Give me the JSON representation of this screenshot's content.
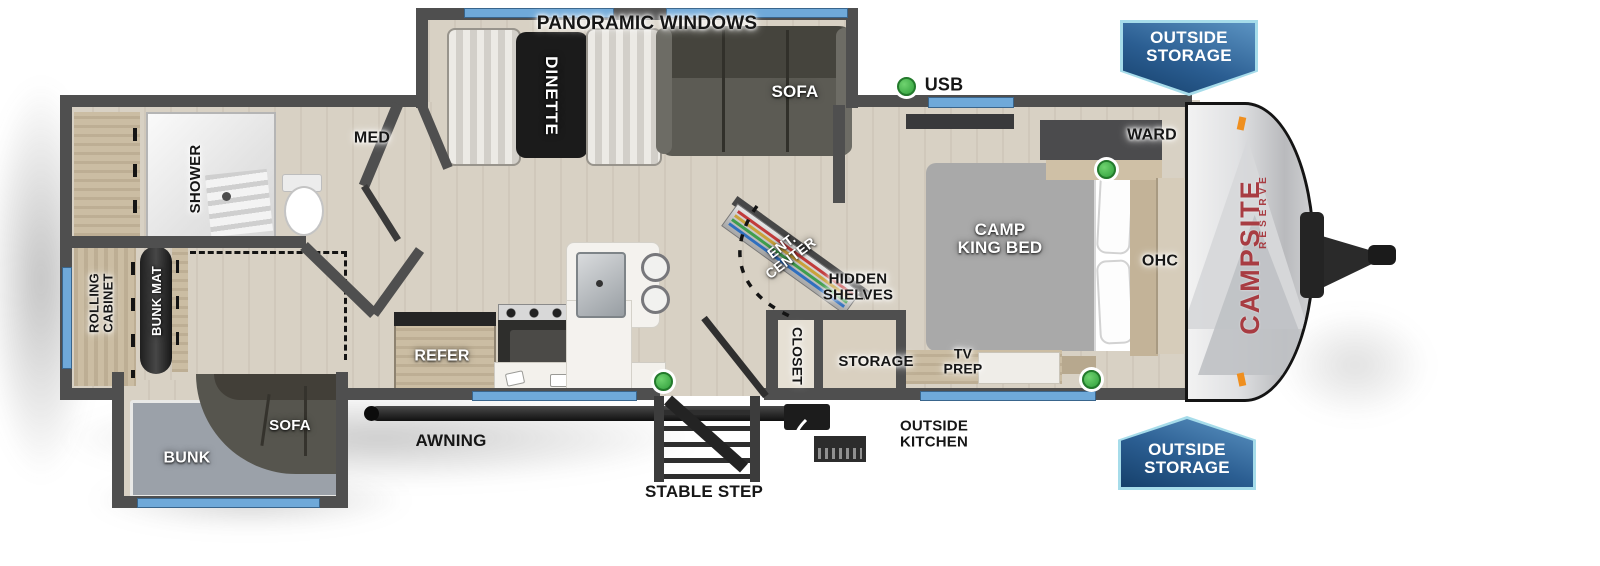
{
  "brand": {
    "line1": "CAMPSITE",
    "line2": "RESERVE",
    "color": "#a83c42"
  },
  "badges": {
    "outside_storage_top": {
      "line1": "OUTSIDE",
      "line2": "STORAGE"
    },
    "outside_storage_bottom": {
      "line1": "OUTSIDE",
      "line2": "STORAGE"
    }
  },
  "indicators": {
    "usb": {
      "label": "USB",
      "dot_color": "#3fae4c"
    }
  },
  "labels": {
    "panoramic_windows": {
      "text": "PANORAMIC WINDOWS"
    },
    "dinette": {
      "text": "DINETTE"
    },
    "sofa_main": {
      "text": "SOFA"
    },
    "med": {
      "text": "MED"
    },
    "shower": {
      "text": "SHOWER"
    },
    "ward": {
      "text": "WARD"
    },
    "ohc": {
      "text": "OHC"
    },
    "camp_king_bed": {
      "line1": "CAMP",
      "line2": "KING BED"
    },
    "ent_center": {
      "line1": "ENT.",
      "line2": "CENTER"
    },
    "hidden_shelves": {
      "line1": "HIDDEN",
      "line2": "SHELVES"
    },
    "closet": {
      "text": "CLOSET"
    },
    "storage": {
      "text": "STORAGE"
    },
    "tv_prep": {
      "line1": "TV",
      "line2": "PREP"
    },
    "refer": {
      "text": "REFER"
    },
    "rolling_cabinet": {
      "line1": "ROLLING",
      "line2": "CABINET"
    },
    "bunk_mat": {
      "text": "BUNK MAT"
    },
    "sofa_slide": {
      "text": "SOFA"
    },
    "bunk": {
      "text": "BUNK"
    },
    "awning": {
      "text": "AWNING"
    },
    "stable_step": {
      "text": "STABLE STEP"
    },
    "outside_kitchen": {
      "line1": "OUTSIDE",
      "line2": "KITCHEN"
    }
  },
  "colors": {
    "wall": "#4f4f4f",
    "floor": "#d8d1c4",
    "window_blue": "#6fa9d9",
    "usb_dot": "#3fae4c",
    "badge_border": "#a6dcea",
    "badge_blue_dark": "#16406b",
    "brand_red": "#a83c42"
  }
}
